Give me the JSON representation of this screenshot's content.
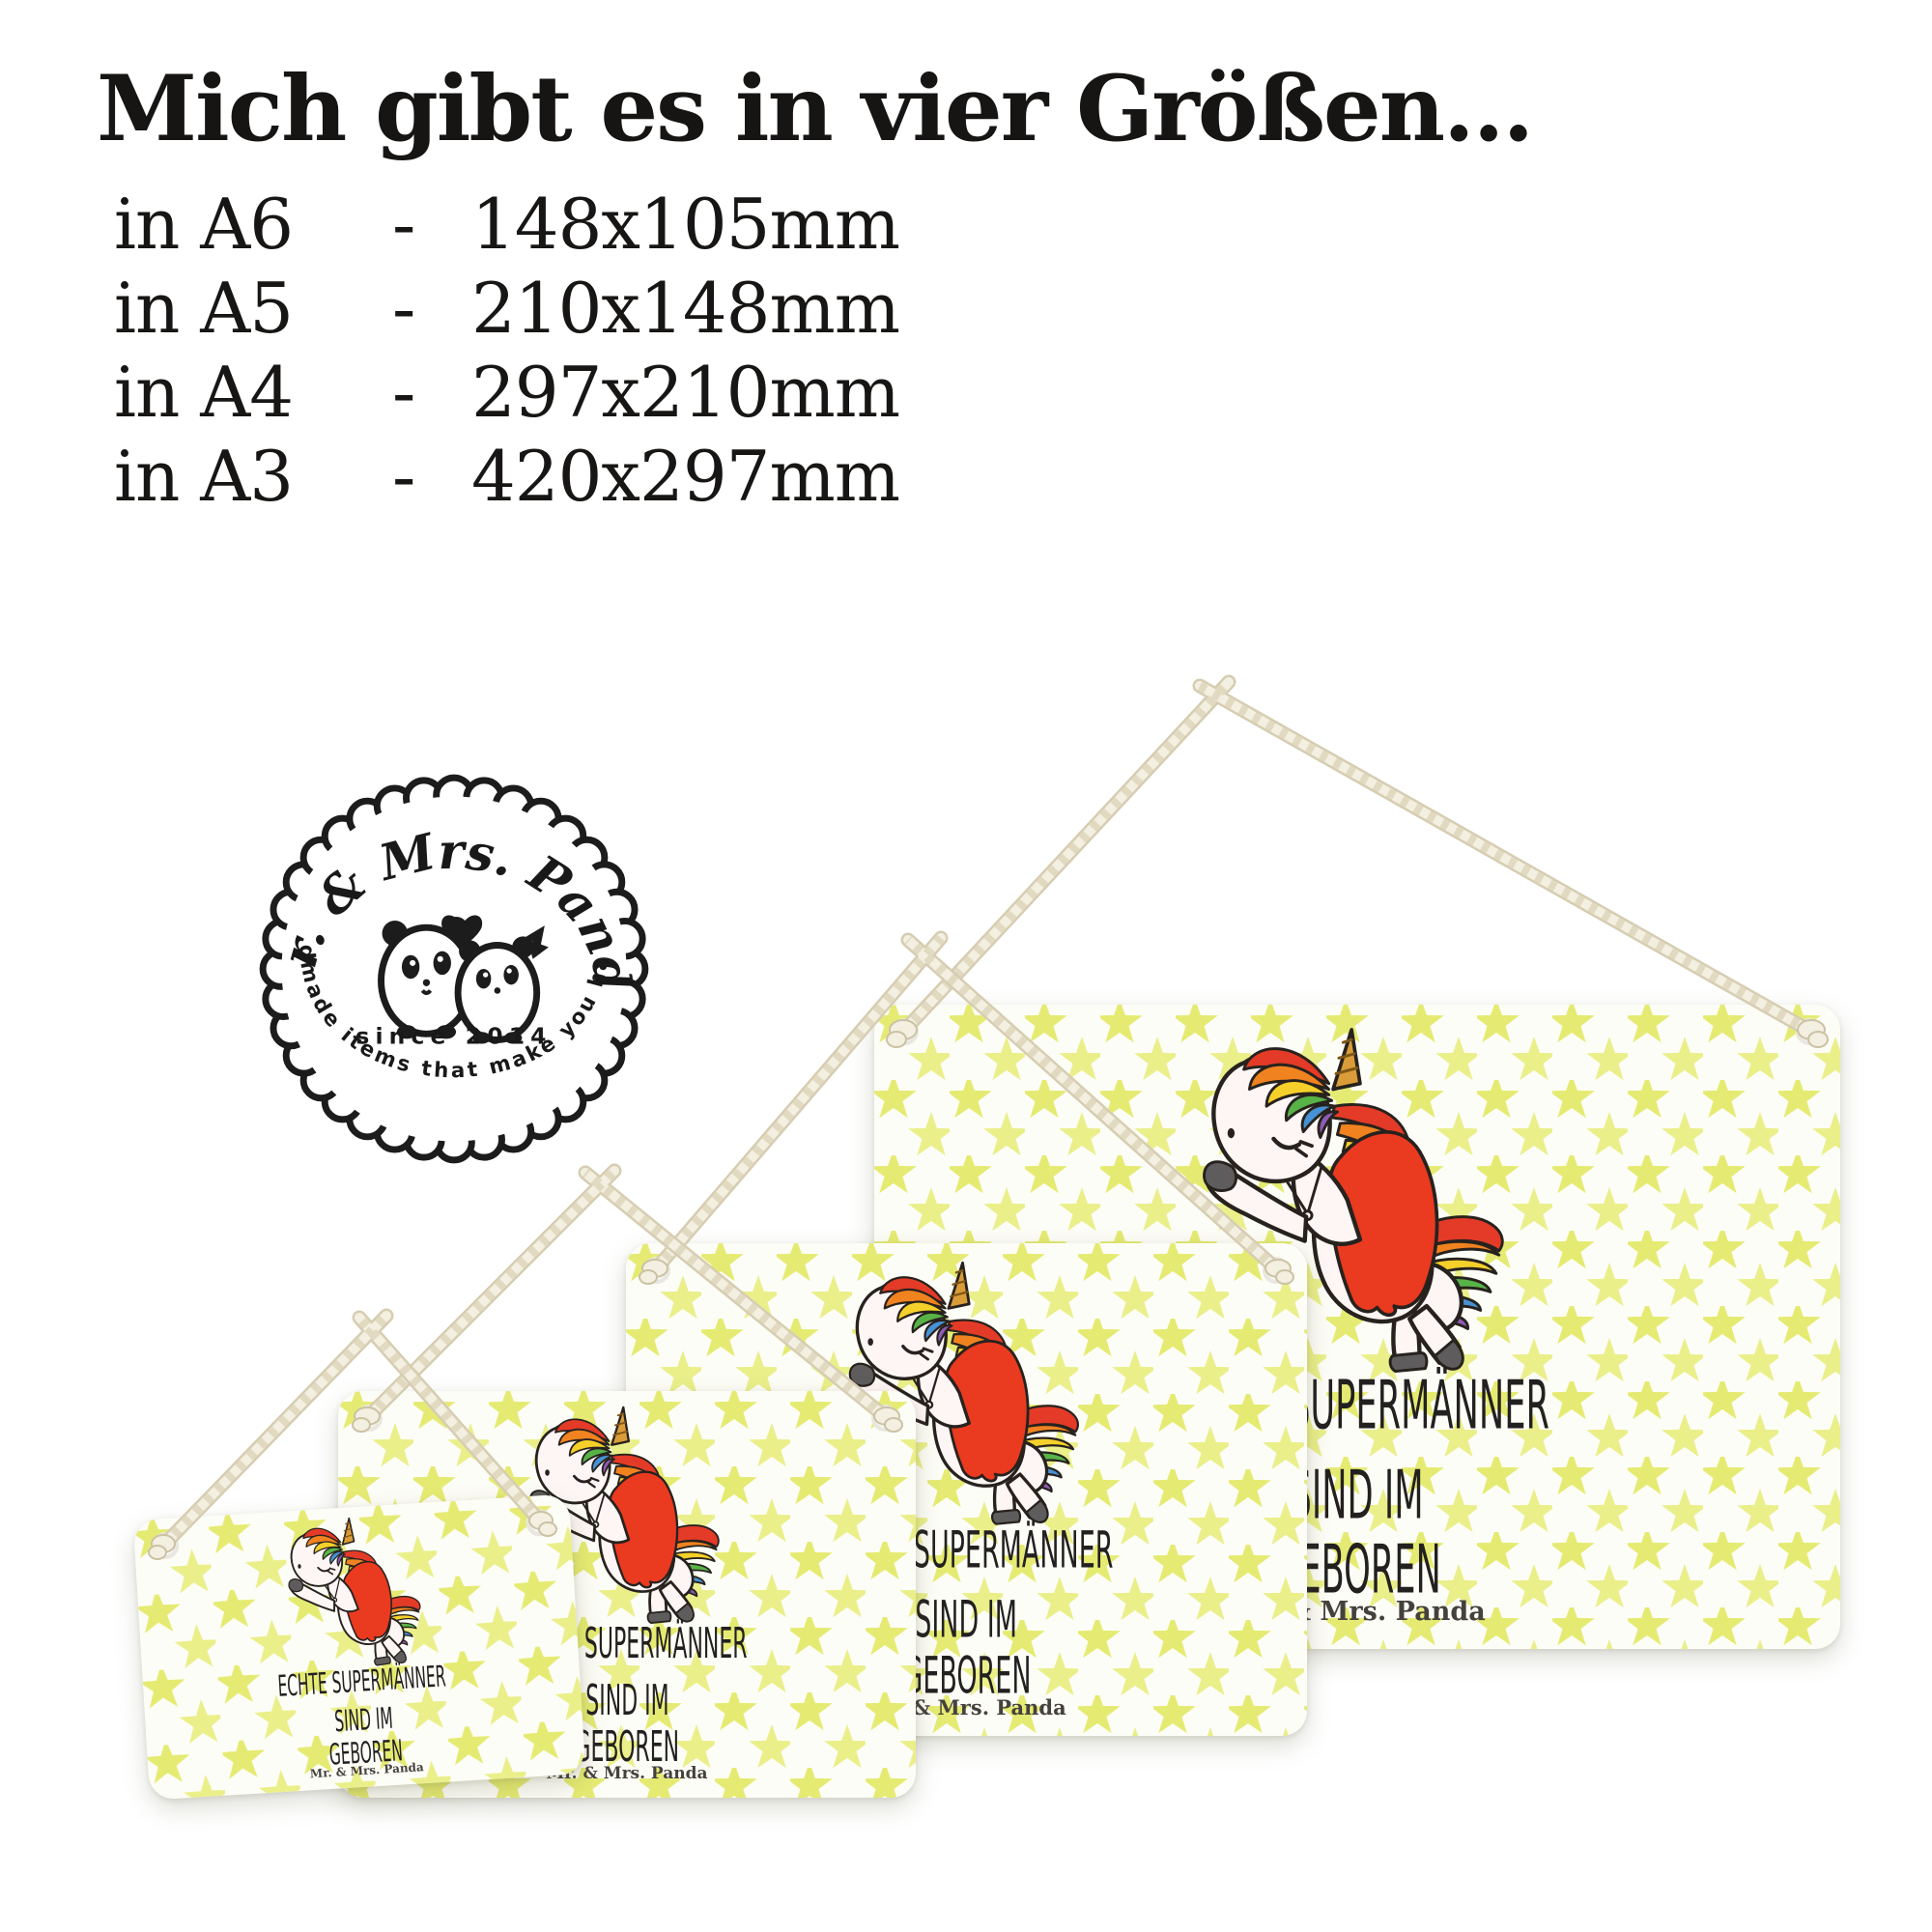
{
  "title": "Mich gibt es in vier Größen...",
  "size_rows": [
    {
      "label": "in A6",
      "sep": "-",
      "value": "148x105mm"
    },
    {
      "label": "in A5",
      "sep": "-",
      "value": "210x148mm"
    },
    {
      "label": "in A4",
      "sep": "-",
      "value": "297x210mm"
    },
    {
      "label": "in A3",
      "sep": "-",
      "value": "420x297mm"
    }
  ],
  "logo": {
    "brand": "Mr. & Mrs. Panda",
    "since": "since 2014",
    "tagline": "Handmade items that make you happy!",
    "heart_icon": "heart",
    "pandas_icon": "panda-couple"
  },
  "sign_text": {
    "line1": "ECHTE SUPERMÄNNER",
    "line2": "SIND IM",
    "line3": "GEBOREN",
    "credit": "Mr. & Mrs. Panda"
  },
  "colors": {
    "star": "#e5eb72",
    "sign_bg": "#fdfdf7",
    "ink": "#27221e",
    "cape": "#ea3a20",
    "horn": "#da9c38",
    "horn_stripe": "#7e5617",
    "hoof": "#5e5c5c",
    "rope": "#f3efe1",
    "rope_shade": "#d6cdb2",
    "rainbow": [
      "#e33b27",
      "#f0831f",
      "#f5d02a",
      "#58b347",
      "#4792d4",
      "#8e5bb5"
    ]
  }
}
